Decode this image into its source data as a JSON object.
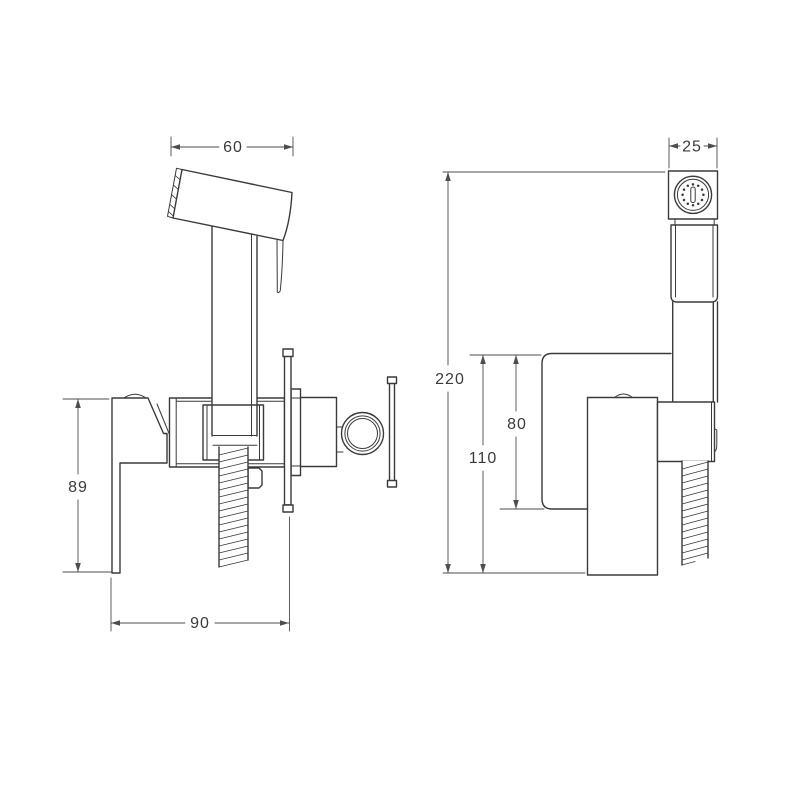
{
  "dims": {
    "front_head_width": "60",
    "front_lever_height": "89",
    "front_depth": "90",
    "side_head_width": "25",
    "side_total_height": "220",
    "side_lower_height": "110",
    "side_plate_height": "80"
  },
  "colors": {
    "line": "#3a3a3a",
    "dimension": "#4d4d4d",
    "background": "#ffffff"
  }
}
